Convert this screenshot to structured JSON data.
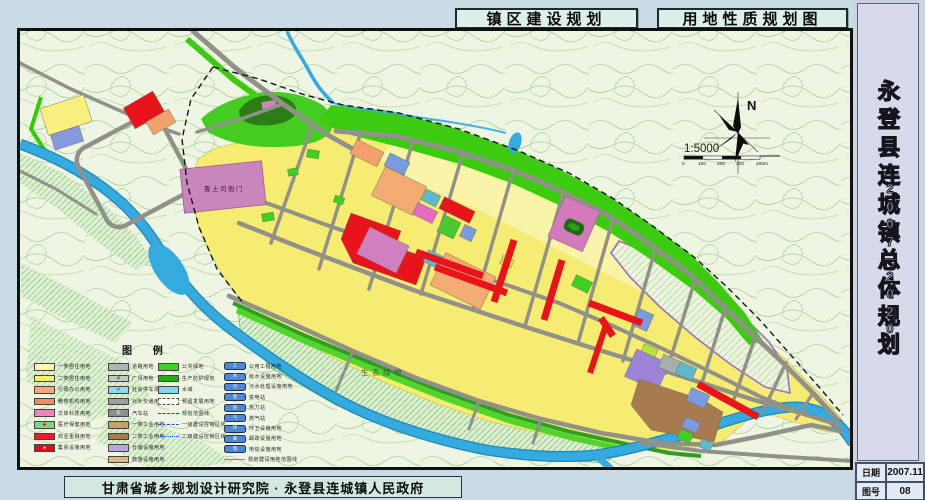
{
  "titles": {
    "left": "镇区建设规划",
    "right": "用地性质规划图"
  },
  "sidebar": {
    "title": "永登县连城镇总体规划",
    "period": "2007—2020",
    "info": [
      {
        "label": "日期",
        "value": "2007.11"
      },
      {
        "label": "图号",
        "value": "08"
      }
    ]
  },
  "footer": {
    "credit": "甘肃省城乡规划设计研究院 · 永登县连城镇人民政府"
  },
  "map": {
    "labels": {
      "eco_green": "生态绿地",
      "historic_site": "鲁土司衙门",
      "north": "N",
      "scale": "1:5000",
      "scale_ticks": [
        "0",
        "100",
        "200",
        "300",
        "400m"
      ]
    },
    "colors": {
      "residential_yellow": "#f6ec72",
      "commercial_red": "#e8141c",
      "green_space": "#3ccb10",
      "water_blue": "#35aade",
      "road_gray": "#9a9a92"
    }
  },
  "legend": {
    "title": "图 例",
    "columns": [
      {
        "items": [
          {
            "label": "一类居住用地",
            "kind": "fill",
            "color": "#fdf8ac"
          },
          {
            "label": "二类居住用地",
            "kind": "fill",
            "color": "#f8ee6e"
          },
          {
            "label": "行政办公用地",
            "kind": "fill",
            "color": "#f4a97c"
          },
          {
            "label": "教育机构用地",
            "kind": "fill",
            "color": "#ef8d62"
          },
          {
            "label": "文体科技用地",
            "kind": "fill",
            "color": "#ef86c0"
          },
          {
            "label": "医疗保健用地",
            "kind": "fill",
            "color": "#7fd483",
            "icon": "✚",
            "iconColor": "#d00000"
          },
          {
            "label": "商业金融用地",
            "kind": "fill",
            "color": "#ee1c25"
          },
          {
            "label": "集贸设施用地",
            "kind": "fill",
            "color": "#dd0f1e",
            "icon": "★",
            "iconColor": "#ffffff"
          }
        ]
      },
      {
        "items": [
          {
            "label": "道路用地",
            "kind": "fill",
            "color": "#b0b4b4"
          },
          {
            "label": "广场用地",
            "kind": "fill",
            "color": "#c2c6c6",
            "icon": "◆",
            "iconColor": "#2a9a2a"
          },
          {
            "label": "社会停车场用地",
            "kind": "fill",
            "color": "#8fd9ea",
            "icon": "P",
            "iconColor": "#084a8a"
          },
          {
            "label": "对外交通用地",
            "kind": "fill",
            "color": "#9aa0a2"
          },
          {
            "label": "汽车站",
            "kind": "fill",
            "color": "#8a9092",
            "icon": "车",
            "iconColor": "#ffffff"
          },
          {
            "label": "一类工业用地",
            "kind": "fill",
            "color": "#c9a063"
          },
          {
            "label": "二类工业用地",
            "kind": "fill",
            "color": "#a87a50"
          },
          {
            "label": "仓储设施用地",
            "kind": "fill",
            "color": "#b9a6de"
          },
          {
            "label": "旅游设施用地",
            "kind": "fill",
            "color": "#e0b87a"
          }
        ]
      },
      {
        "items": [
          {
            "label": "公共绿地",
            "kind": "fill",
            "color": "#3fd023"
          },
          {
            "label": "生产防护绿地",
            "kind": "fill",
            "color": "#2aa81a"
          },
          {
            "label": "水域",
            "kind": "fill",
            "color": "#7fd9f0"
          },
          {
            "label": "预留发展用地",
            "kind": "dashbox",
            "color": "#ffffff"
          },
          {
            "label": "规划范围线",
            "kind": "line",
            "lineStyle": "dashed",
            "color": "#e00010"
          },
          {
            "label": "一级建设控制区线",
            "kind": "line",
            "lineStyle": "dashed",
            "color": "#2255cc"
          },
          {
            "label": "二级建设控制区线",
            "kind": "line",
            "lineStyle": "dotted",
            "color": "#2255cc"
          }
        ]
      },
      {
        "cls": "lg-col4",
        "items": [
          {
            "label": "公用工程用地",
            "kind": "blueicon",
            "color": "#4f86d8",
            "icon": "工"
          },
          {
            "label": "给水设施用地",
            "kind": "blueicon",
            "color": "#4f86d8",
            "icon": "水"
          },
          {
            "label": "污水处理设施用地",
            "kind": "blueicon",
            "color": "#4f86d8",
            "icon": "污"
          },
          {
            "label": "变电站",
            "kind": "blueicon",
            "color": "#4f86d8",
            "icon": "变"
          },
          {
            "label": "热力站",
            "kind": "blueicon",
            "color": "#4f86d8",
            "icon": "热"
          },
          {
            "label": "燃气站",
            "kind": "blueicon",
            "color": "#4f86d8",
            "icon": "气"
          },
          {
            "label": "环卫设施用地",
            "kind": "blueicon",
            "color": "#4f86d8",
            "icon": "环"
          },
          {
            "label": "邮政设施用地",
            "kind": "blueicon",
            "color": "#4f86d8",
            "icon": "邮"
          },
          {
            "label": "电信设施用地",
            "kind": "blueicon",
            "color": "#4f86d8",
            "icon": "电"
          },
          {
            "label": "规划建设用地范围线",
            "kind": "line",
            "lineStyle": "solid",
            "color": "#9b6fc0"
          }
        ]
      }
    ]
  }
}
